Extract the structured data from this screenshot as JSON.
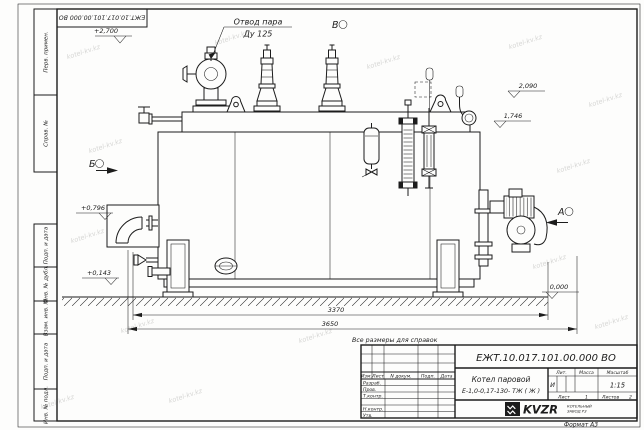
{
  "watermark": "kotel-kv.kz",
  "frame": {
    "reversed_designation": "ЕЖТ.10.017.101.00.000  ВО",
    "left_fields": [
      "Перв. примен.",
      "Справ. №",
      "Подп. и дата",
      "Инв. № дубл.",
      "Взам. инв. №",
      "Подп. и дата",
      "Инв. № подл."
    ],
    "format_label": "Формат А3"
  },
  "drawing": {
    "callout": {
      "line1": "Отвод пара",
      "line2": "Ду 125"
    },
    "views": {
      "a": "А",
      "b": "Б",
      "v": "В"
    },
    "elevations": {
      "top": "+2,700",
      "right_upper": "2,090",
      "right_lower": "1,746",
      "left_upper": "+0,796",
      "left_lower": "+0,143",
      "ground": "0,000"
    },
    "dimensions": {
      "inner": "3370",
      "overall": "3650"
    },
    "note": "Все размеры для справок"
  },
  "title_block": {
    "designation": "ЕЖТ.10.017.101.00.000  ВО",
    "product_line1": "Котел паровой",
    "product_line2": "Е-1,0-0,17-130- ТЖ ( Ж )",
    "columns": {
      "izm": "Изм.",
      "list": "Лист",
      "ndoc": "N докум.",
      "podp": "Подп.",
      "data": "Дата"
    },
    "rows": {
      "razrab": "Разраб.",
      "prov": "Пров.",
      "tkontr": "Т.контр.",
      "nkontr": "Н.контр.",
      "utv": "Утв."
    },
    "lit_header": "Лит.",
    "mass_header": "Масса",
    "scale_header": "Масштаб",
    "lit_value": "И",
    "scale_value": "1:15",
    "sheet_label": "Лист",
    "sheet_value": "1",
    "sheets_label": "Листов",
    "sheets_value": "2",
    "logo_text": "KVZR",
    "company_line1": "КОТЕЛЬНЫЙ",
    "company_line2": "ЗАВОД РЗ",
    "format_label": "Формат А3"
  }
}
